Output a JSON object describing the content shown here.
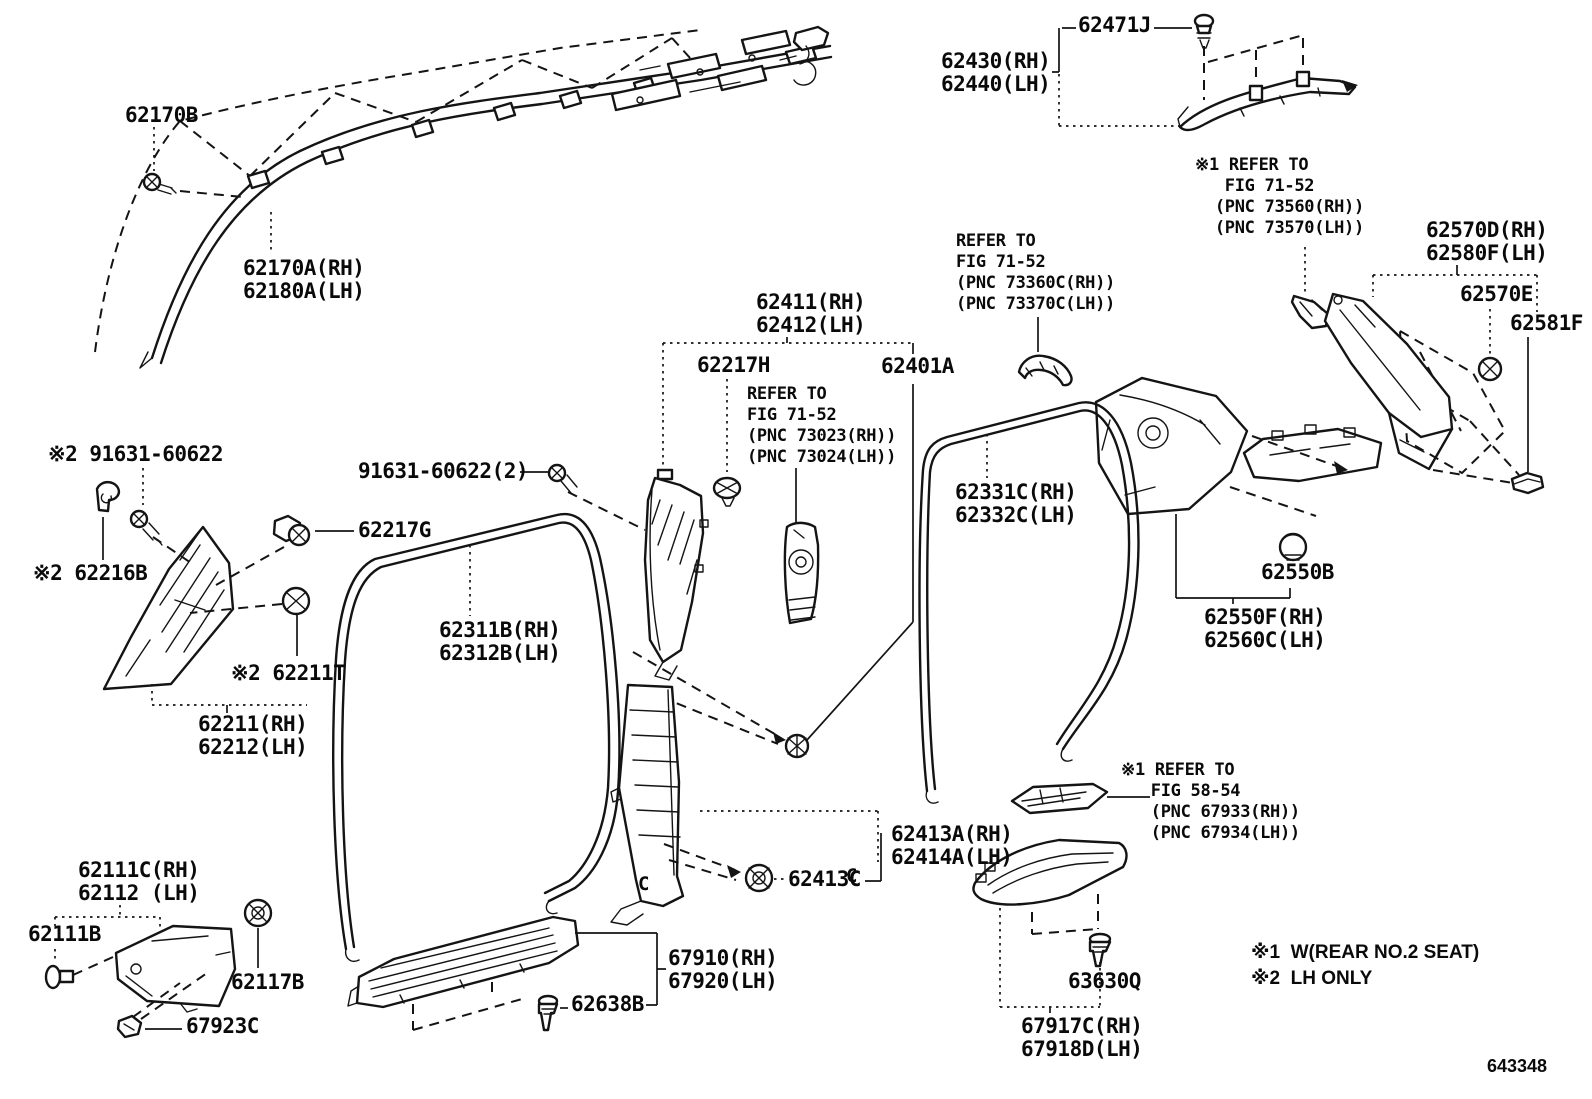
{
  "figure": {
    "code": "643348"
  },
  "colors": {
    "line": "#141414",
    "background": "#ffffff"
  },
  "notes": {
    "n1": "※1  W(REAR NO.2 SEAT)",
    "n2": "※2  LH ONLY"
  },
  "markers": {
    "c1": "C",
    "c2": "C"
  },
  "parts": {
    "p62170B": "62170B",
    "p62170A": "62170A(RH)\n62180A(LH)",
    "p62471J": "62471J",
    "p62430": "62430(RH)\n62440(LH)",
    "p62570D": "62570D(RH)\n62580F(LH)",
    "p62570E": "62570E",
    "p62581F": "62581F",
    "p62411": "62411(RH)\n62412(LH)",
    "p62217H": "62217H",
    "p62401A": "62401A",
    "p62331C": "62331C(RH)\n62332C(LH)",
    "p91631a": "※2 91631-60622",
    "p91631b": "91631-60622(2)",
    "p62217G": "62217G",
    "p62216B": "※2 62216B",
    "p62211T": "※2 62211T",
    "p62311B": "62311B(RH)\n62312B(LH)",
    "p62211": "62211(RH)\n62212(LH)",
    "p62550B": "62550B",
    "p62550F": "62550F(RH)\n62560C(LH)",
    "p62413A": "62413A(RH)\n62414A(LH)",
    "p62413C": "62413C",
    "p62111C": "62111C(RH)\n62112 (LH)",
    "p62111B": "62111B",
    "p62117B": "62117B",
    "p67923C": "67923C",
    "p67910": "67910(RH)\n67920(LH)",
    "p62638B": "62638B",
    "p63630Q": "63630Q",
    "p67917C": "67917C(RH)\n67918D(LH)"
  },
  "refs": {
    "r73560": "※1 REFER TO\n   FIG 71-52\n  (PNC 73560(RH))\n  (PNC 73570(LH))",
    "r73360C": "REFER TO\nFIG 71-52\n(PNC 73360C(RH))\n(PNC 73370C(LH))",
    "r73023": "REFER TO\nFIG 71-52\n(PNC 73023(RH))\n(PNC 73024(LH))",
    "r67933": "※1 REFER TO\n   FIG 58-54\n   (PNC 67933(RH))\n   (PNC 67934(LH))"
  }
}
